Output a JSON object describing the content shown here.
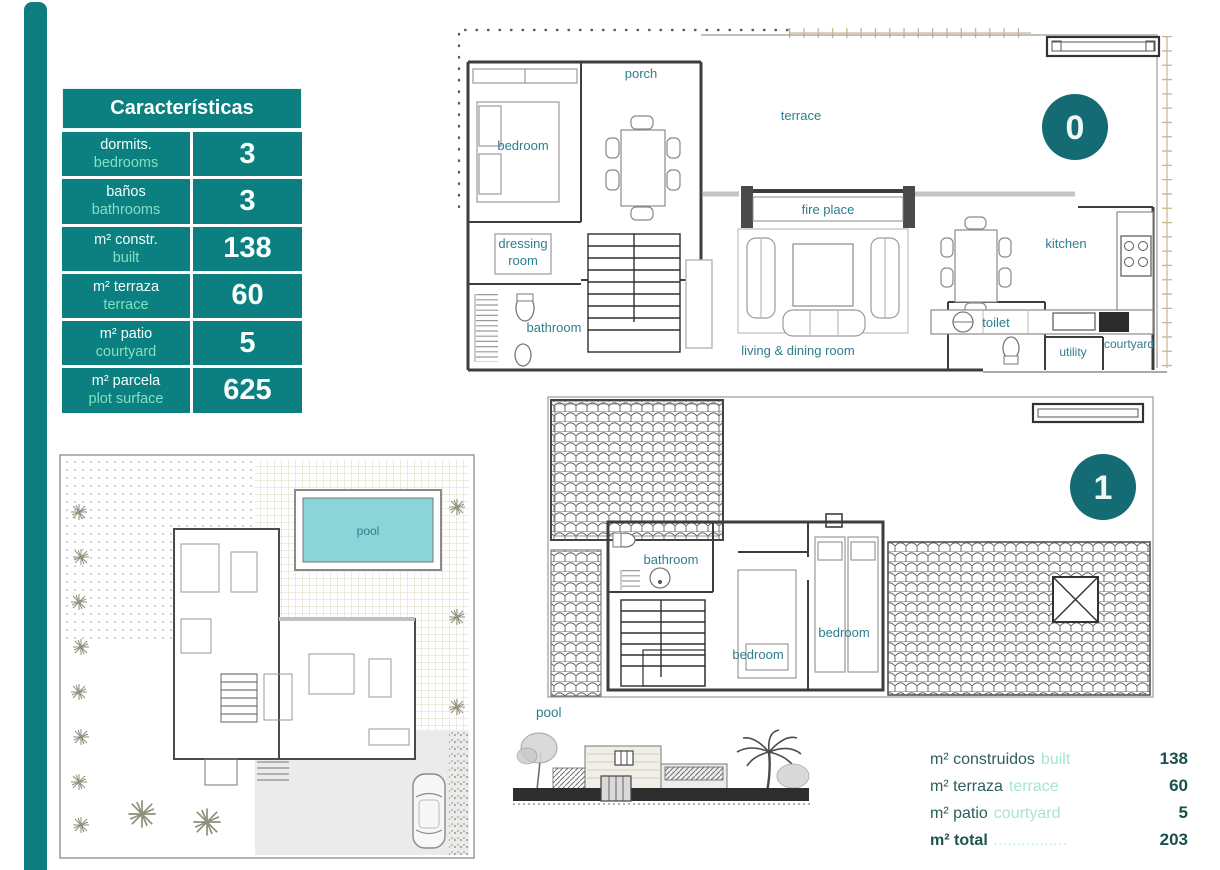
{
  "page": {
    "accent_teal": "#0d7d7f",
    "badge_teal": "#146b73",
    "mint": "#7fe3c0",
    "plan_label_teal": "#2d7e8e",
    "pool_fill": "#8ad5d8"
  },
  "characteristics_table": {
    "title": "Características",
    "rows": [
      {
        "es": "dormits.",
        "en": "bedrooms",
        "value": "3"
      },
      {
        "es": "baños",
        "en": "bathrooms",
        "value": "3"
      },
      {
        "es": "m² constr.",
        "en": "built",
        "value": "138"
      },
      {
        "es": "m² terraza",
        "en": "terrace",
        "value": "60"
      },
      {
        "es": "m² patio",
        "en": "courtyard",
        "value": "5"
      },
      {
        "es": "m² parcela",
        "en": "plot surface",
        "value": "625"
      }
    ]
  },
  "floor0": {
    "badge": "0",
    "labels": {
      "bedroom": "bedroom",
      "porch": "porch",
      "terrace": "terrace",
      "fireplace": "fire place",
      "dressing_line1": "dressing",
      "dressing_line2": "room",
      "bathroom": "bathroom",
      "living": "living & dining room",
      "kitchen": "kitchen",
      "toilet": "toilet",
      "utility": "utility",
      "courtyard": "courtyard"
    }
  },
  "floor1": {
    "badge": "1",
    "labels": {
      "bathroom": "bathroom",
      "bedroom_center": "bedroom",
      "bedroom_right": "bedroom"
    }
  },
  "site_plan": {
    "pool": "pool"
  },
  "elevation_caption": "pool",
  "summary": {
    "rows": [
      {
        "es": "m² construidos",
        "en": "built",
        "value": "138"
      },
      {
        "es": "m² terraza",
        "en": "terrace",
        "value": "60"
      },
      {
        "es": "m² patio",
        "en": "courtyard",
        "value": "5"
      },
      {
        "es": "m² total",
        "en": "................",
        "value": "203"
      }
    ]
  }
}
